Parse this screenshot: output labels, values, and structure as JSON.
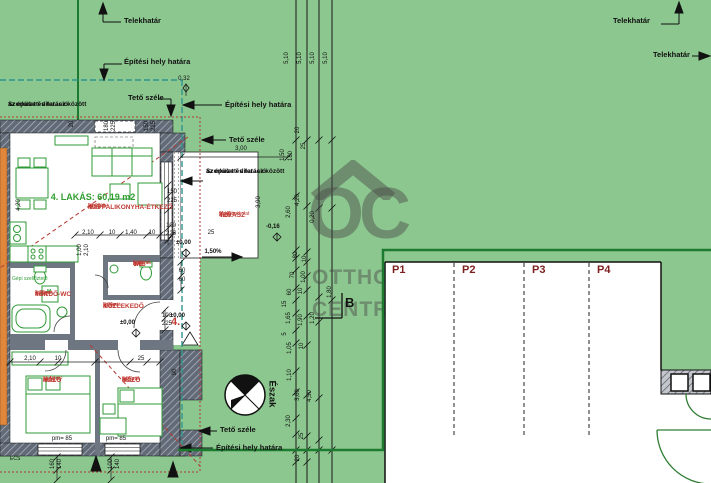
{
  "watermark": {
    "initials": "OC",
    "line1": "OTTHON",
    "line2": "CENTRUM"
  },
  "boundaries": {
    "telekhatar": "Telekhatár",
    "epitesi_hely": "Építési hely határa",
    "teto_szele": "Tető széle",
    "dilatacio_line1": "Szerkezeti dilatáció",
    "dilatacio_line2": "az épület és terasz között"
  },
  "compass": {
    "label": "Észak"
  },
  "section_marker": "B",
  "unit_number": "4.",
  "apartment": {
    "title": "4. LAKÁS: 60,19 m2",
    "rooms": [
      {
        "code": "4/05",
        "name": "NAPPALIKONYHA-ÉTKEZŐ",
        "finish": "laminált",
        "area": "27,28 m²"
      },
      {
        "code": "4/07",
        "name": "TERASZ",
        "finish": "térkő burkolat",
        "area": "11,40 m²"
      },
      {
        "code": "4/06",
        "name": "WC",
        "finish": "kerámia",
        "area": "1,50 m²"
      },
      {
        "code": "4/04",
        "name": "FÜRDŐ-WC",
        "finish": "kerámia",
        "area": "4,30 m²"
      },
      {
        "code": "4/01",
        "name": "KÖZLEKEDŐ",
        "finish": "kerámia",
        "area": "7,00 m²"
      },
      {
        "code": "4/03",
        "name": "HÁLÓ",
        "finish": "parketta",
        "area": "11,52 m²"
      },
      {
        "code": "4/02",
        "name": "HÁLÓ",
        "finish": "parketta",
        "area": "9,57 m²"
      }
    ],
    "levels": {
      "zero": "±0,00",
      "minus": "-0,16"
    },
    "slope": "1,50%",
    "window_sill": "pm= 85",
    "fixtures": {
      "washer": "M",
      "vent_note": "Gépi szellőztető",
      "gutter": "ECS"
    }
  },
  "parking": {
    "stalls": [
      "P1",
      "P2",
      "P3",
      "P4"
    ]
  },
  "dims": {
    "vertical": [
      "5,10",
      "5,10",
      "5,10",
      "5,10",
      "1,50",
      "20",
      "25",
      "180",
      "4,20",
      "2,60",
      "0,20",
      "80",
      "10",
      "70",
      "1,00",
      "60",
      "10",
      "1,80",
      "15",
      "1,65",
      "1,90",
      "1,20",
      "5",
      "1,05",
      "10",
      "1,10",
      "3,60",
      "4,50",
      "2,30",
      "25",
      "20",
      "3,90",
      "180",
      "225",
      "150",
      "225",
      "20",
      "4,20",
      "1,00",
      "2,10",
      "160",
      "140",
      "100",
      "140",
      "90"
    ],
    "horizontal": [
      "0,32",
      "3,00",
      "2,10",
      "10",
      "1,40",
      "10",
      "25",
      "2,10",
      "10",
      "25",
      "150",
      "225",
      "100",
      "225",
      "60",
      "60",
      "100",
      "225"
    ]
  },
  "colors": {
    "background": "#8cc78f",
    "plot_boundary": "#1d7b30",
    "site_boundary": "#2f958d",
    "roof_edge": "#b23b32",
    "wall": "#616a76",
    "furniture": "#2f9b35",
    "room_label": "#c13a34",
    "apartment_title": "#2f9e2f",
    "parking_label": "#7d1f1f"
  }
}
